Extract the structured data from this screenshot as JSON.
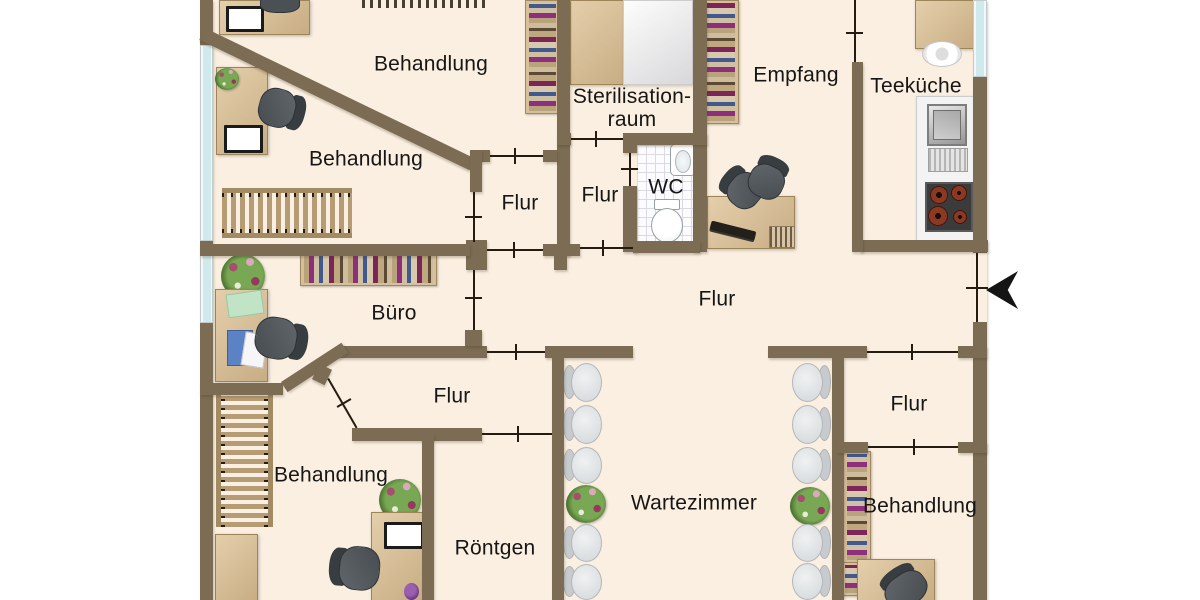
{
  "diagram_type": "floor-plan",
  "language": "de",
  "description": "Grundriss einer Arztpraxis (medical practice floor plan, top-down view)",
  "rooms": [
    {
      "id": "behandlung-top",
      "label": "Behandlung"
    },
    {
      "id": "behandlung-upper",
      "label": "Behandlung"
    },
    {
      "id": "sterilisationsraum",
      "label": "Sterilisation-\nraum"
    },
    {
      "id": "flur-upper-left",
      "label": "Flur"
    },
    {
      "id": "flur-upper-right",
      "label": "Flur"
    },
    {
      "id": "wc",
      "label": "WC"
    },
    {
      "id": "empfang",
      "label": "Empfang"
    },
    {
      "id": "teekueche",
      "label": "Teeküche"
    },
    {
      "id": "flur-central",
      "label": "Flur"
    },
    {
      "id": "buero",
      "label": "Büro"
    },
    {
      "id": "flur-lower-left",
      "label": "Flur"
    },
    {
      "id": "flur-right",
      "label": "Flur"
    },
    {
      "id": "behandlung-lower-left",
      "label": "Behandlung"
    },
    {
      "id": "wartezimmer",
      "label": "Wartezimmer"
    },
    {
      "id": "roentgen",
      "label": "Röntgen"
    },
    {
      "id": "behandlung-lower-right",
      "label": "Behandlung"
    }
  ],
  "icons": {
    "entrance_arrow": "left-pointing entrance arrow at main door on right exterior wall"
  },
  "colors": {
    "floor": "#faefe0",
    "wall": "#7b6c53",
    "door_line": "#241b11",
    "window_glass": "#cfe9ec",
    "wood_furniture": "#d5bc97",
    "office_chair": "#54595d",
    "waiting_chair": "#e0e3e5",
    "arrow": "#141414",
    "background": "#ffffff"
  }
}
